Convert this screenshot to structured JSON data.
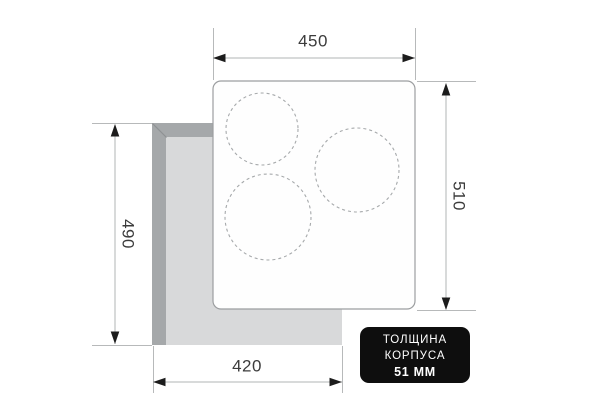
{
  "diagram": {
    "type": "hob-installation-dimensions",
    "dimensions": {
      "top_width_mm": "450",
      "right_height_mm": "510",
      "left_height_mm": "490",
      "bottom_width_mm": "420"
    },
    "badge": {
      "line1": "ТОЛЩИНА",
      "line2": "КОРПУСА",
      "line3": "51 ММ"
    },
    "burner_zones": 3,
    "colors": {
      "background": "#ffffff",
      "body_edge_dark": "#a5a8aa",
      "body_bevel": "#8e9194",
      "body_surface_light": "#d8d9da",
      "panel_fill": "#fefefe",
      "panel_border": "#9c9ea0",
      "burner_dash": "#a6a9ab",
      "dimension_line": "#b2b4b6",
      "arrow": "#1c1c1c",
      "label_text": "#3c3c3c",
      "badge_bg": "#0e0e0e",
      "badge_text": "#ffffff"
    }
  }
}
